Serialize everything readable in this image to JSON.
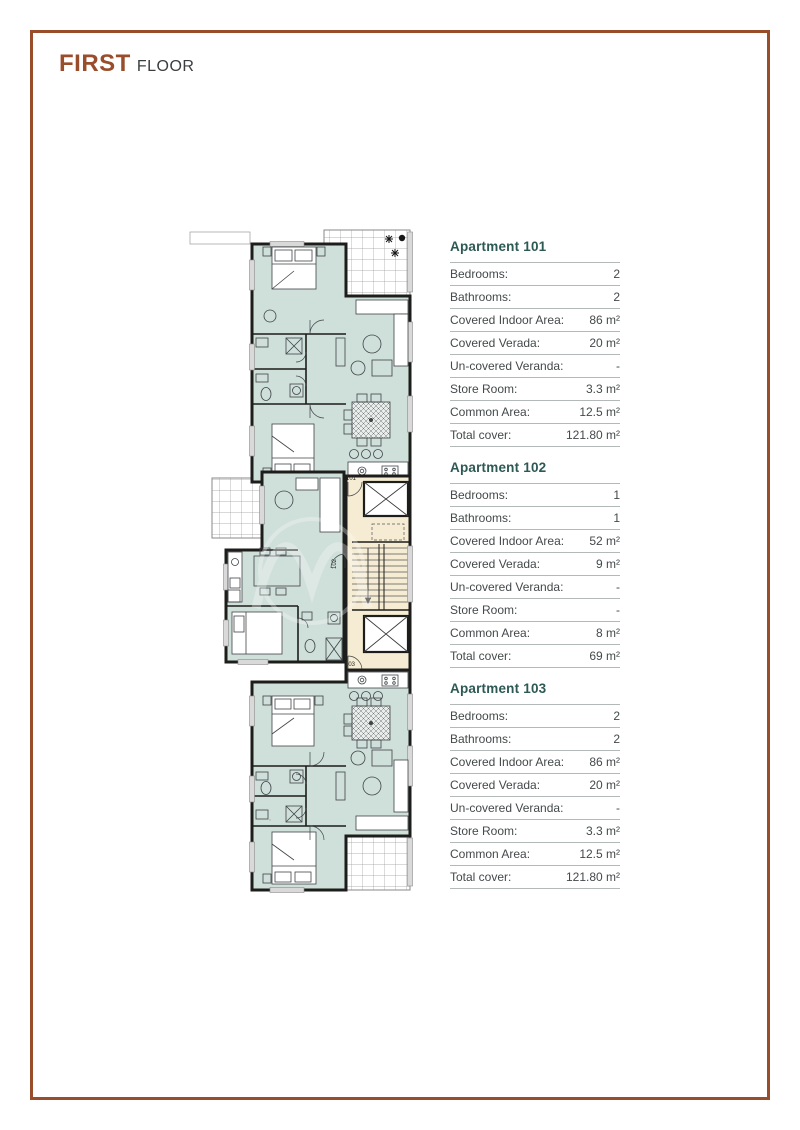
{
  "page": {
    "title_primary": "FIRST",
    "title_secondary": "FLOOR"
  },
  "colors": {
    "accent": "#9a4d2b",
    "heading_teal": "#2d5954",
    "room_fill": "#cfdfda",
    "core_fill": "#f6ecd3",
    "wall": "#1d1d1b"
  },
  "plan": {
    "unit_labels": [
      "101",
      "102",
      "103"
    ]
  },
  "apartments": [
    {
      "name": "Apartment 101",
      "rows": [
        {
          "label": "Bedrooms:",
          "value": "2"
        },
        {
          "label": "Bathrooms:",
          "value": "2"
        },
        {
          "label": "Covered Indoor Area:",
          "value": "86 m²"
        },
        {
          "label": "Covered Verada:",
          "value": "20 m²"
        },
        {
          "label": "Un-covered Veranda:",
          "value": "-"
        },
        {
          "label": "Store Room:",
          "value": "3.3 m²"
        },
        {
          "label": "Common Area:",
          "value": "12.5 m²"
        },
        {
          "label": "Total cover:",
          "value": "121.80 m²"
        }
      ]
    },
    {
      "name": "Apartment 102",
      "rows": [
        {
          "label": "Bedrooms:",
          "value": "1"
        },
        {
          "label": "Bathrooms:",
          "value": "1"
        },
        {
          "label": "Covered Indoor Area:",
          "value": "52 m²"
        },
        {
          "label": "Covered Verada:",
          "value": "9 m²"
        },
        {
          "label": "Un-covered Veranda:",
          "value": "-"
        },
        {
          "label": "Store Room:",
          "value": "-"
        },
        {
          "label": "Common Area:",
          "value": "8 m²"
        },
        {
          "label": "Total cover:",
          "value": "69 m²"
        }
      ]
    },
    {
      "name": "Apartment 103",
      "rows": [
        {
          "label": "Bedrooms:",
          "value": "2"
        },
        {
          "label": "Bathrooms:",
          "value": "2"
        },
        {
          "label": "Covered Indoor Area:",
          "value": "86 m²"
        },
        {
          "label": "Covered Verada:",
          "value": "20 m²"
        },
        {
          "label": "Un-covered Veranda:",
          "value": "-"
        },
        {
          "label": "Store Room:",
          "value": "3.3 m²"
        },
        {
          "label": "Common Area:",
          "value": "12.5 m²"
        },
        {
          "label": "Total cover:",
          "value": "121.80 m²"
        }
      ]
    }
  ]
}
